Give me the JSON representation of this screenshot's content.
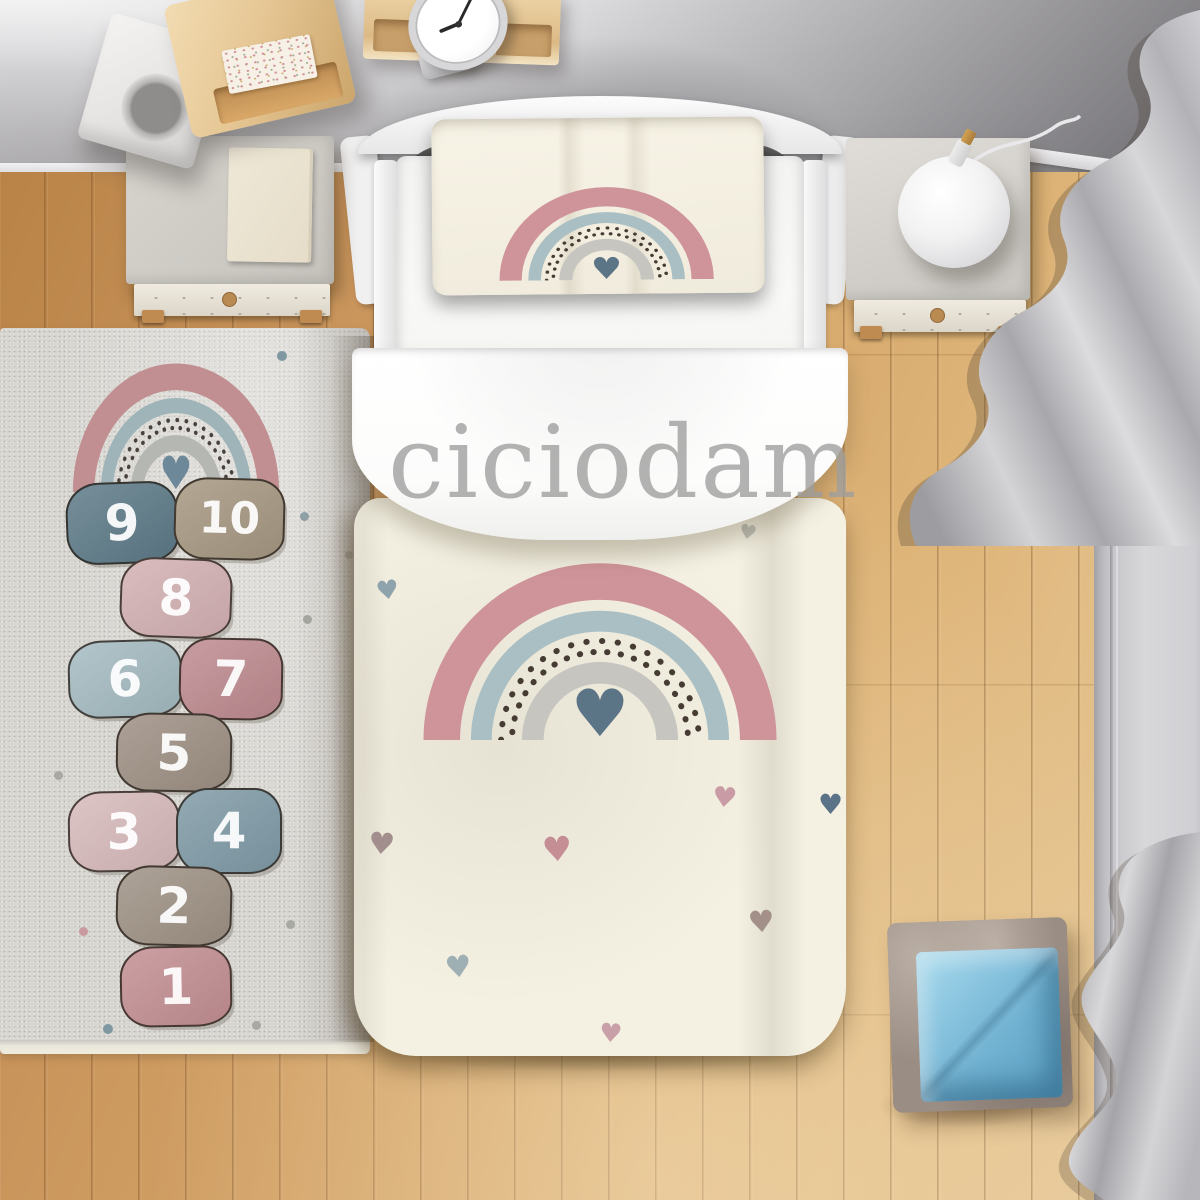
{
  "watermark": {
    "text": "ciciodam"
  },
  "rug": {
    "base_color": "#d7d5d0",
    "rainbow": {
      "pink": "#c18f92",
      "blue": "#9eb4b8",
      "gray": "#b5b7b2",
      "dots": "#4a423c",
      "heart": "#6d8898"
    },
    "hopscotch": [
      {
        "label": "1",
        "color": "#c28e92"
      },
      {
        "label": "2",
        "color": "#9e9184"
      },
      {
        "label": "3",
        "color": "#d6b9ba"
      },
      {
        "label": "4",
        "color": "#7f9aa6"
      },
      {
        "label": "5",
        "color": "#9d8f83"
      },
      {
        "label": "6",
        "color": "#a3bac0"
      },
      {
        "label": "7",
        "color": "#bd8a8f"
      },
      {
        "label": "8",
        "color": "#d3b0b2"
      },
      {
        "label": "9",
        "color": "#5c7987"
      },
      {
        "label": "10",
        "color": "#a59781"
      }
    ]
  },
  "bedding": {
    "duvet_color": "#f4f1e3",
    "heart_glyph": "♥",
    "rainbow": {
      "pink": "#cf949a",
      "blue": "#a9bfc4",
      "gray": "#c6c5c0",
      "dots": "#473c34",
      "heart": "#5b7486"
    }
  },
  "palette": {
    "wall": "#c6c5c8",
    "floor_wood": "#d3a367",
    "curtain": "#c6c5c8",
    "cube_outer": "#9a8d84",
    "cube_inner": "#6fb3d4"
  }
}
